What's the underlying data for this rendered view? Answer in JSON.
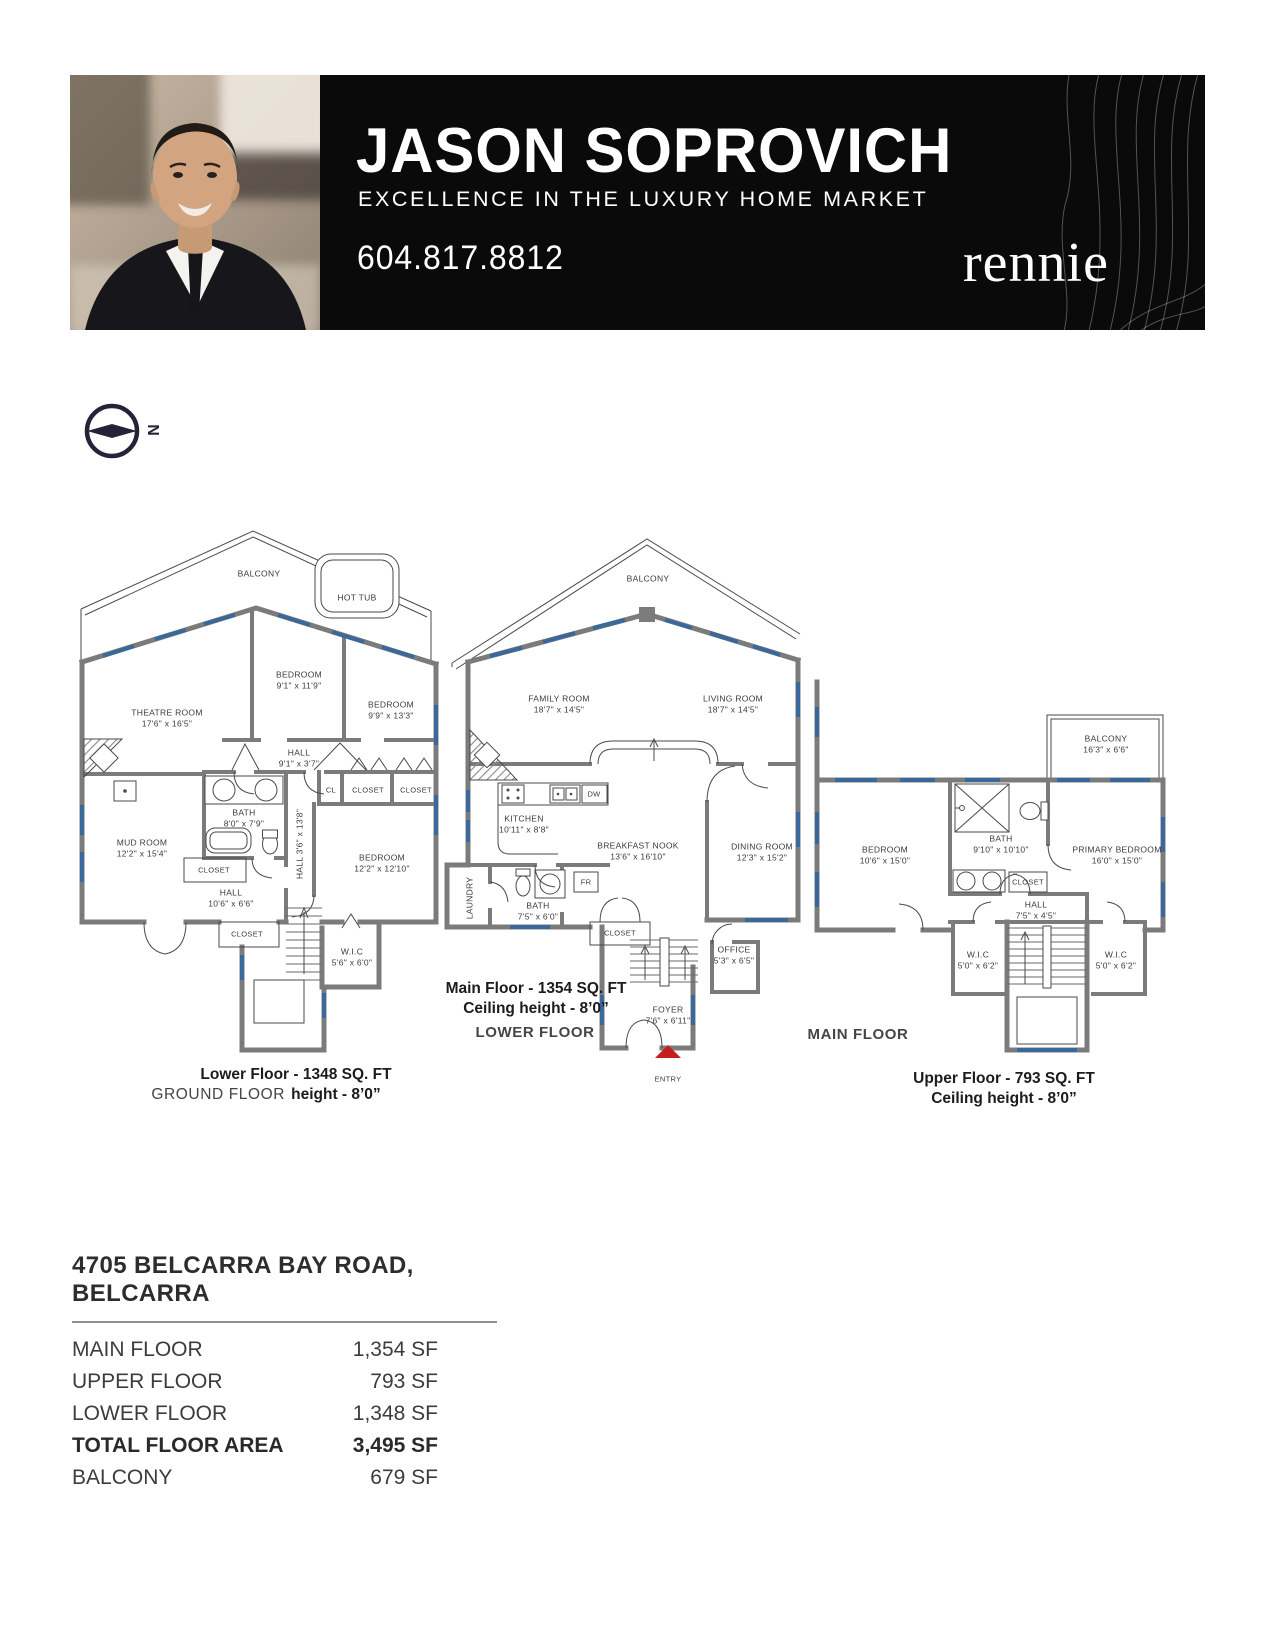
{
  "header": {
    "agent_name": "JASON SOPROVICH",
    "tagline": "EXCELLENCE IN THE LUXURY HOME MARKET",
    "phone": "604.817.8812",
    "brand": "rennie"
  },
  "compass": {
    "north_label": "N"
  },
  "plans": {
    "lower": {
      "caption_title": "Lower Floor - 1348 SQ. FT",
      "caption_prefix": "GROUND FLOOR",
      "caption_height": "height - 8’0”",
      "rooms": {
        "balcony": {
          "name": "BALCONY"
        },
        "hot_tub": {
          "name": "HOT TUB"
        },
        "bedroom_top": {
          "name": "BEDROOM",
          "dims": "9'1\" x 11'9\""
        },
        "theatre": {
          "name": "THEATRE ROOM",
          "dims": "17'6\" x 16'5\""
        },
        "bedroom_right": {
          "name": "BEDROOM",
          "dims": "9'9\" x 13'3\""
        },
        "hall_top": {
          "name": "HALL",
          "dims": "9'1\" x 3'7\""
        },
        "cl": {
          "name": "CL"
        },
        "closet_a": {
          "name": "CLOSET"
        },
        "closet_b": {
          "name": "CLOSET"
        },
        "bath": {
          "name": "BATH",
          "dims": "8'0\" x 7'9\""
        },
        "mud_room": {
          "name": "MUD ROOM",
          "dims": "12'2\" x 15'4\""
        },
        "hall_mid": {
          "name": "HALL  3'6\" x 13'8\""
        },
        "bedroom_lower": {
          "name": "BEDROOM",
          "dims": "12'2\" x 12'10\""
        },
        "closet_c": {
          "name": "CLOSET"
        },
        "hall_lower": {
          "name": "HALL",
          "dims": "10'6\" x 6'6\""
        },
        "closet_d": {
          "name": "CLOSET"
        },
        "wic": {
          "name": "W.I.C",
          "dims": "5'6\" x 6'0\""
        }
      }
    },
    "main": {
      "caption_title": "Main Floor - 1354 SQ. FT",
      "caption_height": "Ceiling height - 8’0”",
      "floor_label": "LOWER FLOOR",
      "rooms": {
        "balcony": {
          "name": "BALCONY"
        },
        "family": {
          "name": "FAMILY ROOM",
          "dims": "18'7\" x 14'5\""
        },
        "living": {
          "name": "LIVING ROOM",
          "dims": "18'7\" x 14'5\""
        },
        "kitchen": {
          "name": "KITCHEN",
          "dims": "10'11\" x 8'8\""
        },
        "dw": {
          "name": "DW"
        },
        "nook": {
          "name": "BREAKFAST NOOK",
          "dims": "13'6\" x 16'10\""
        },
        "dining": {
          "name": "DINING ROOM",
          "dims": "12'3\" x 15'2\""
        },
        "laundry": {
          "name": "LAUNDRY"
        },
        "bath": {
          "name": "BATH",
          "dims": "7'5\" x 6'0\""
        },
        "fr": {
          "name": "FR"
        },
        "closet": {
          "name": "CLOSET"
        },
        "office": {
          "name": "OFFICE",
          "dims": "5'3\" x 6'5\""
        },
        "foyer": {
          "name": "FOYER",
          "dims": "7'6\" x 6'11\""
        },
        "entry": {
          "name": "ENTRY"
        }
      }
    },
    "upper": {
      "caption_title": "Upper Floor - 793 SQ. FT",
      "caption_height": "Ceiling height - 8’0”",
      "floor_label": "MAIN FLOOR",
      "rooms": {
        "balcony": {
          "name": "BALCONY",
          "dims": "16'3\" x 6'6\""
        },
        "bedroom": {
          "name": "BEDROOM",
          "dims": "10'6\" x 15'0\""
        },
        "bath": {
          "name": "BATH",
          "dims": "9'10\" x 10'10\""
        },
        "primary": {
          "name": "PRIMARY BEDROOM",
          "dims": "16'0\" x 15'0\""
        },
        "closet": {
          "name": "CLOSET"
        },
        "hall": {
          "name": "HALL",
          "dims": "7'5\" x 4'5\""
        },
        "wic_left": {
          "name": "W.I.C",
          "dims": "5'0\" x 6'2\""
        },
        "wic_right": {
          "name": "W.I.C",
          "dims": "5'0\" x 6'2\""
        }
      }
    }
  },
  "summary": {
    "address": "4705 BELCARRA BAY ROAD, BELCARRA",
    "rows": [
      {
        "label": "MAIN FLOOR",
        "value": "1,354 SF"
      },
      {
        "label": "UPPER FLOOR",
        "value": "793 SF"
      },
      {
        "label": "LOWER FLOOR",
        "value": "1,348 SF"
      },
      {
        "label": "TOTAL FLOOR AREA",
        "value": "3,495 SF"
      },
      {
        "label": "BALCONY",
        "value": "679 SF"
      }
    ]
  },
  "colors": {
    "banner_bg": "#0a0a0a",
    "wall_gray": "#7b7b7b",
    "window_blue": "#39689b",
    "entry_red": "#c41e1e"
  }
}
